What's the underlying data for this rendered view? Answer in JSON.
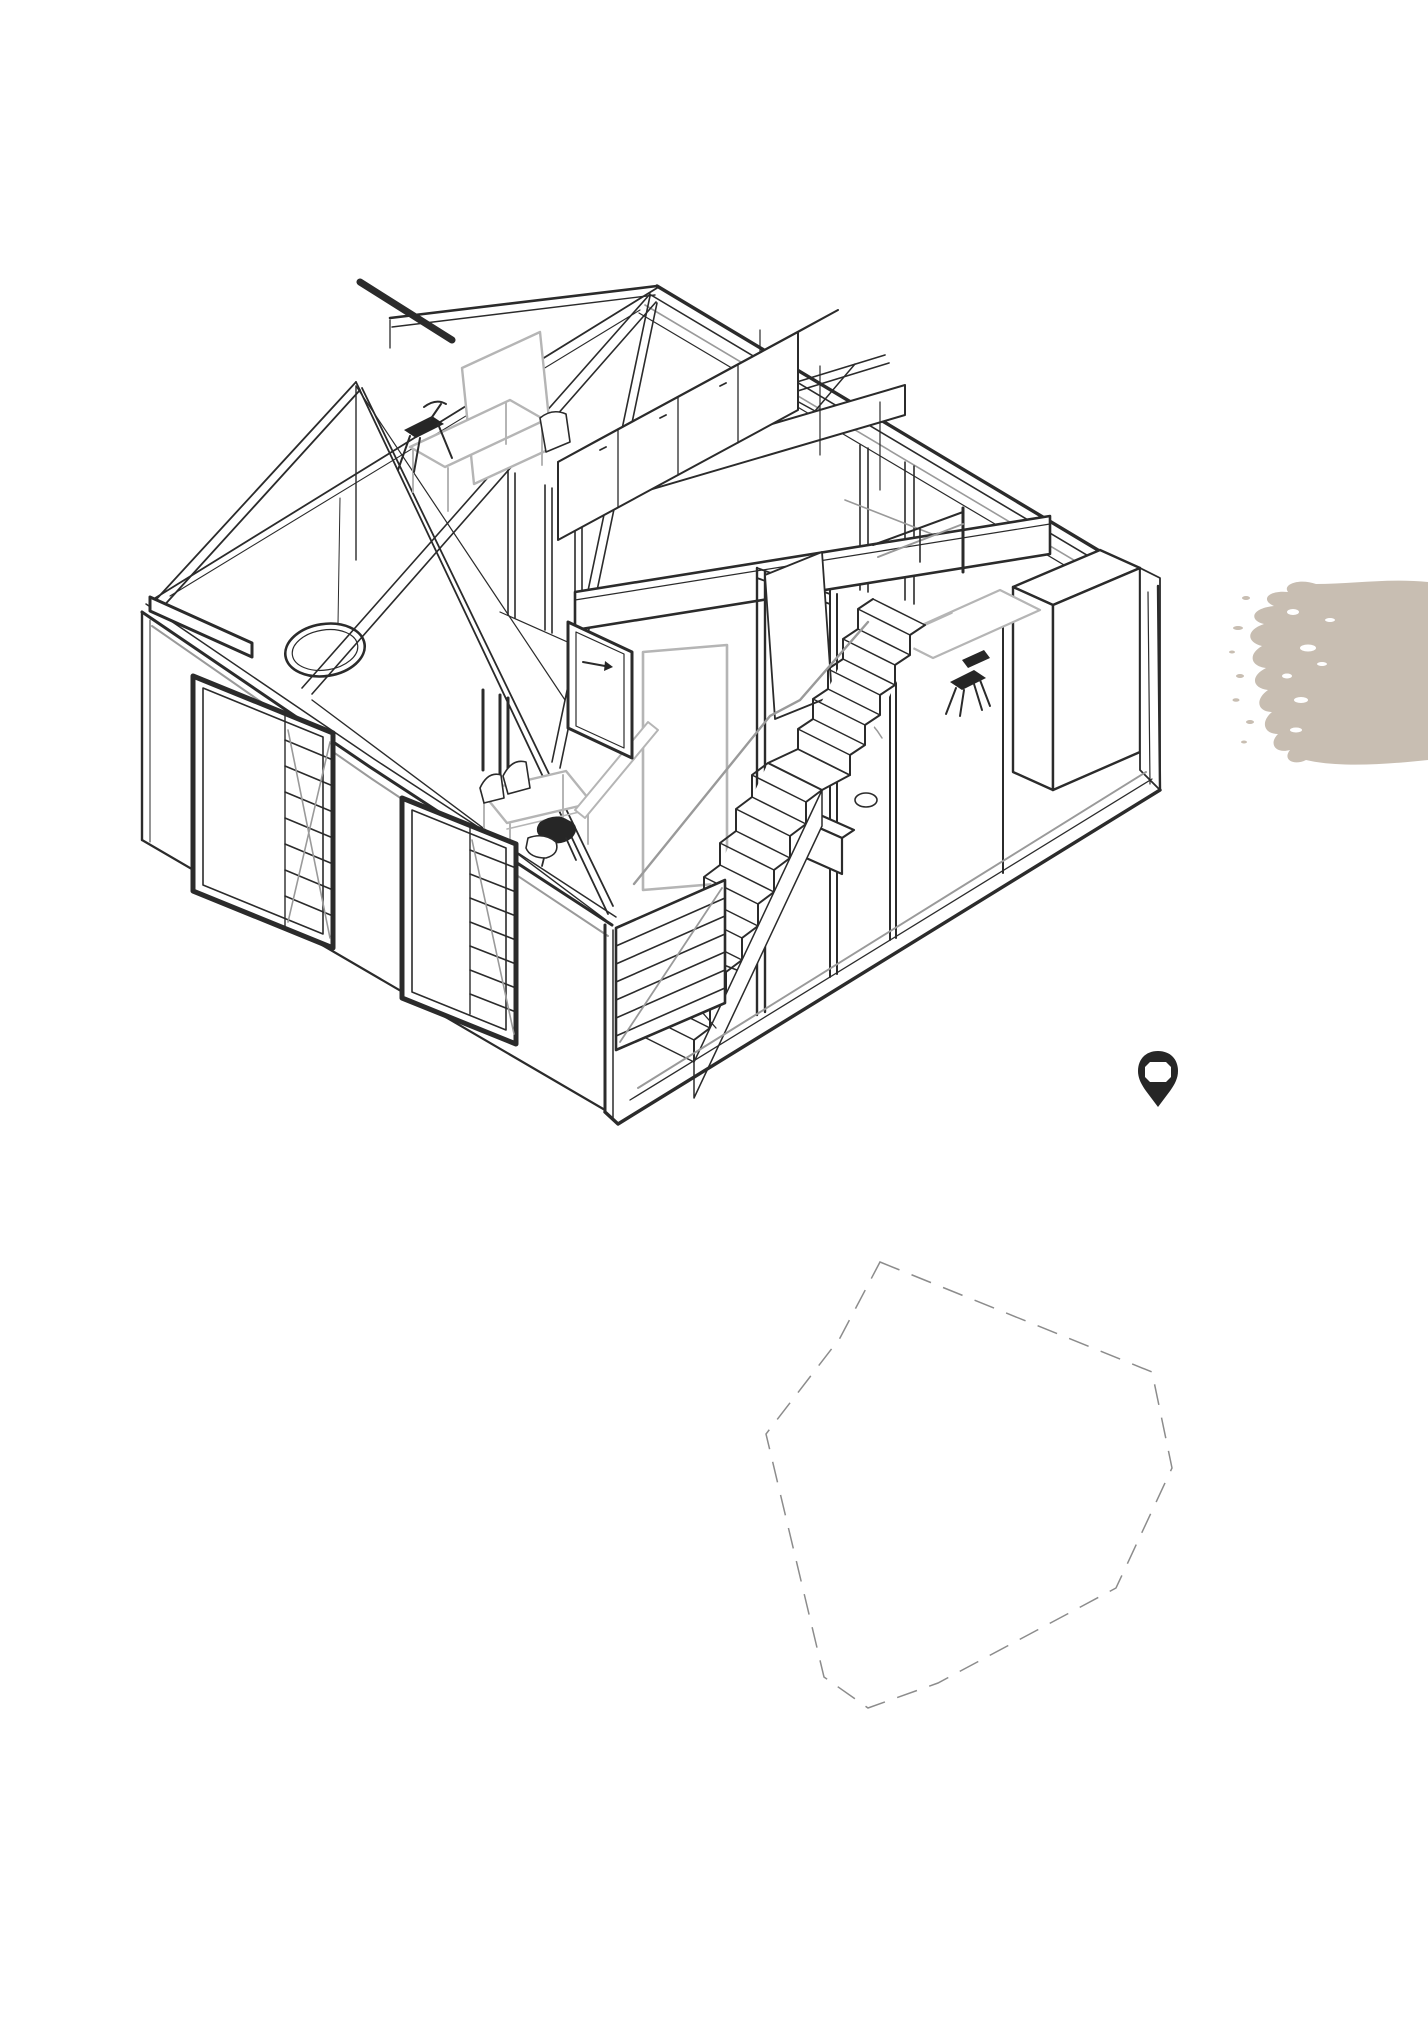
{
  "page": {
    "background": "#ffffff",
    "width": 1428,
    "height": 2028
  },
  "drawing": {
    "description": "axonometric cutaway line drawing of a two-storey house interior with roof trusses, staircase, furniture and slatted window shutters",
    "line_color": "#2b2b2b",
    "light_line_color": "#b5b5b5",
    "mid_line_color": "#9a9a9a"
  },
  "paint_swatch": {
    "fill": "#c8beb2"
  },
  "location_pin": {
    "fill": "#262626"
  },
  "site_outline": {
    "stroke": "#8c8c8c",
    "dasharray": "21 13",
    "points": "880,1262 1152,1372 1172,1468 1116,1588 938,1683 868,1708 824,1677 766,1434 840,1338"
  }
}
